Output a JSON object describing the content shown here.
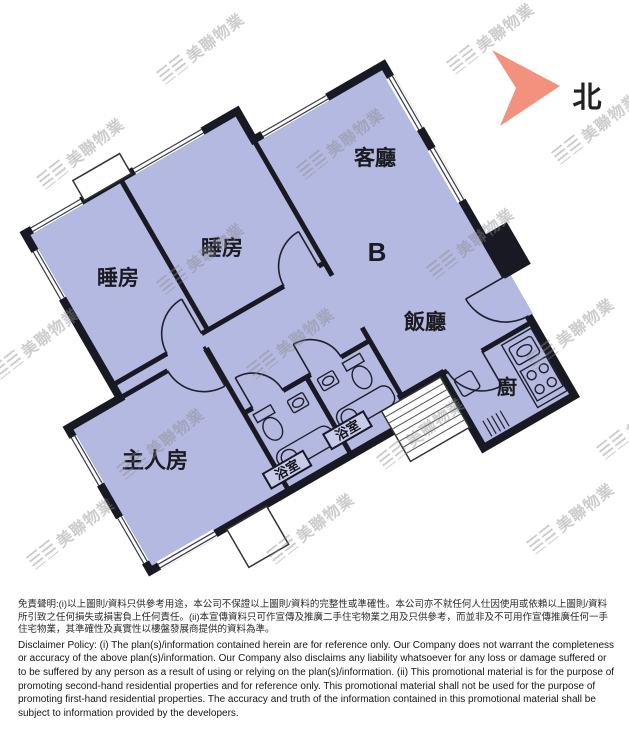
{
  "page": {
    "background": "#ffffff"
  },
  "floor_plan": {
    "unit_label": "B",
    "north_label": "北",
    "colors": {
      "floor_fill": "#b3b9e1",
      "wall": "#191924",
      "north_arrow": "#f2917e",
      "watermark_gray": "#8a8a8a"
    },
    "rooms": {
      "living": {
        "label": "客廳"
      },
      "dining": {
        "label": "飯廳"
      },
      "bedroom1": {
        "label": "睡房"
      },
      "bedroom2": {
        "label": "睡房"
      },
      "master": {
        "label": "主人房"
      },
      "bath1": {
        "label": "浴室"
      },
      "bath2": {
        "label": "浴室"
      },
      "kitchen": {
        "label": "廚"
      }
    }
  },
  "watermark": {
    "text": "美聯物業"
  },
  "disclaimer": {
    "zh": "免責聲明:(i)以上圖則/資料只供參考用途，本公司不保證以上圖則/資料的完整性或準確性。本公司亦不就任何人仕因使用或依賴以上圖則/資料所引致之任何損失或損害負上任何責任。(ii)本宣傳資料只可作宣傳及推廣二手住宅物業之用及只供參考，而並非及不可用作宣傳推廣任何一手住宅物業，其準確性及真實性以樓盤發展商提供的資料為準。",
    "en": "Disclaimer Policy: (i) The plan(s)/information contained herein are for reference only. Our Company does not warrant the completeness or accuracy of the above plan(s)/information. Our Company also disclaims any liability whatsoever for any loss or damage suffered or to be suffered by any person as a result of using or relying on the plan(s)/information. (ii) This promotional material is for the purpose of promoting second-hand residential properties and for reference only. This promotional material shall not be used for the purpose of promoting first-hand residential properties. The accuracy and truth of the information contained in this promotional material shall be subject to information provided by the developers."
  }
}
